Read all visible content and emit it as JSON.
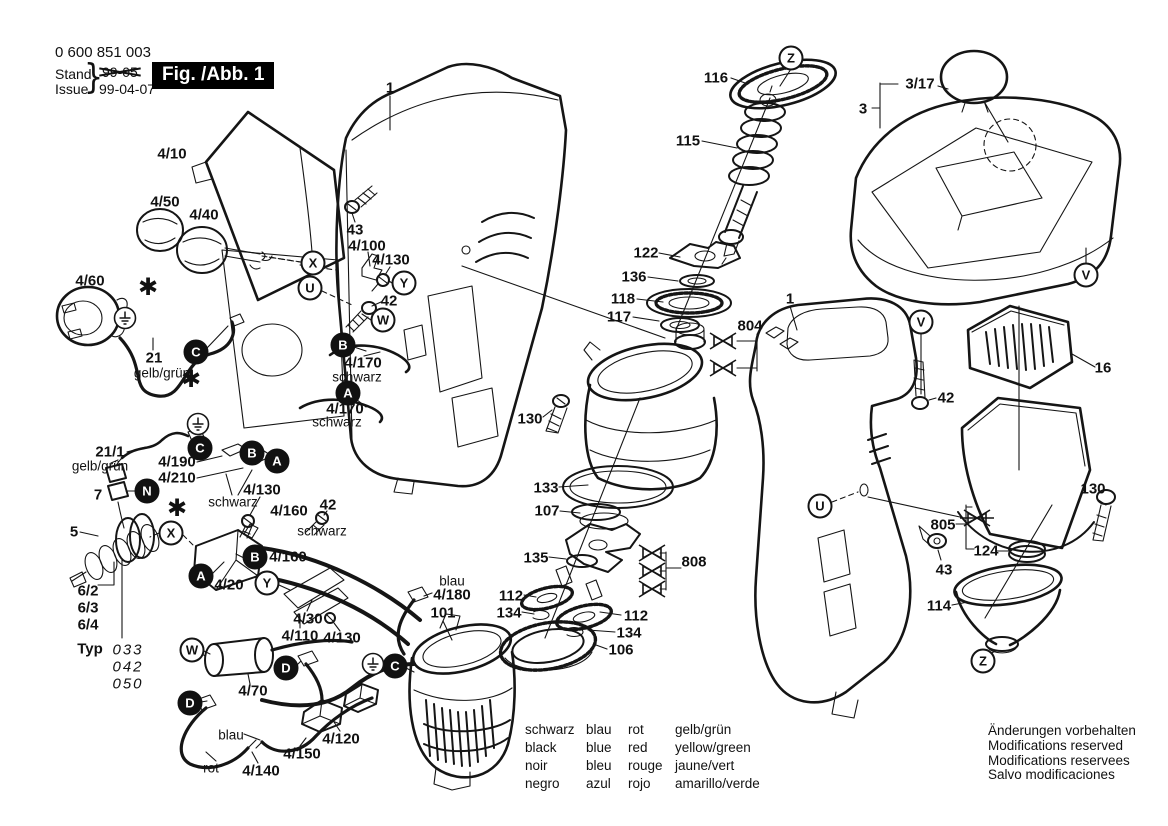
{
  "doc": {
    "part_number": "0 600 851 003",
    "stand_label": "Stand",
    "issue_label": "Issue",
    "brace": "}",
    "old_date": "99-05",
    "issue_date": "99-04-07",
    "figure_label": "Fig. /Abb. 1"
  },
  "legend": {
    "columns": [
      {
        "lines": [
          "schwarz",
          "black",
          "noir",
          "negro"
        ]
      },
      {
        "lines": [
          "blau",
          "blue",
          "bleu",
          "azul"
        ]
      },
      {
        "lines": [
          "rot",
          "red",
          "rouge",
          "rojo"
        ]
      },
      {
        "lines": [
          "gelb/grün",
          "yellow/green",
          "jaune/vert",
          "amarillo/verde"
        ]
      }
    ]
  },
  "footer": {
    "lines": [
      "Änderungen vorbehalten",
      "Modifications reserved",
      "Modifications reservees",
      "Salvo modificaciones"
    ]
  },
  "callout_labels": [
    {
      "text": "4/10",
      "x": 172,
      "y": 154
    },
    {
      "text": "4/50",
      "x": 165,
      "y": 202
    },
    {
      "text": "4/40",
      "x": 204,
      "y": 215
    },
    {
      "text": "4/60",
      "x": 90,
      "y": 281
    },
    {
      "text": "21",
      "x": 154,
      "y": 358
    },
    {
      "text": "gelb/grün",
      "x": 162,
      "y": 373,
      "style": "color-word"
    },
    {
      "text": "21/1",
      "x": 110,
      "y": 452
    },
    {
      "text": "gelb/grün",
      "x": 100,
      "y": 466,
      "style": "color-word"
    },
    {
      "text": "7",
      "x": 98,
      "y": 495
    },
    {
      "text": "5",
      "x": 74,
      "y": 532
    },
    {
      "text": "6/2",
      "x": 88,
      "y": 591
    },
    {
      "text": "6/3",
      "x": 88,
      "y": 608
    },
    {
      "text": "6/4",
      "x": 88,
      "y": 625
    },
    {
      "text": "Typ",
      "x": 90,
      "y": 649
    },
    {
      "text": "033",
      "x": 128,
      "y": 650,
      "style": "italic"
    },
    {
      "text": "042",
      "x": 128,
      "y": 667,
      "style": "italic"
    },
    {
      "text": "050",
      "x": 128,
      "y": 684,
      "style": "italic"
    },
    {
      "text": "4/190",
      "x": 177,
      "y": 462
    },
    {
      "text": "4/210",
      "x": 177,
      "y": 478
    },
    {
      "text": "schwarz",
      "x": 233,
      "y": 502,
      "style": "color-word"
    },
    {
      "text": "4/130",
      "x": 262,
      "y": 490
    },
    {
      "text": "42",
      "x": 328,
      "y": 505
    },
    {
      "text": "4/160",
      "x": 289,
      "y": 511
    },
    {
      "text": "schwarz",
      "x": 322,
      "y": 531,
      "style": "color-word"
    },
    {
      "text": "4/160",
      "x": 288,
      "y": 557
    },
    {
      "text": "4/20",
      "x": 229,
      "y": 585
    },
    {
      "text": "4/30",
      "x": 308,
      "y": 619
    },
    {
      "text": "4/110",
      "x": 300,
      "y": 636
    },
    {
      "text": "4/130",
      "x": 342,
      "y": 638
    },
    {
      "text": "4/70",
      "x": 253,
      "y": 691
    },
    {
      "text": "blau",
      "x": 231,
      "y": 735,
      "style": "color-word"
    },
    {
      "text": "rot",
      "x": 211,
      "y": 768,
      "style": "color-word"
    },
    {
      "text": "4/140",
      "x": 261,
      "y": 771
    },
    {
      "text": "4/150",
      "x": 302,
      "y": 754
    },
    {
      "text": "4/120",
      "x": 341,
      "y": 739
    },
    {
      "text": "blau",
      "x": 452,
      "y": 581,
      "style": "color-word"
    },
    {
      "text": "4/180",
      "x": 452,
      "y": 595
    },
    {
      "text": "101",
      "x": 443,
      "y": 613
    },
    {
      "text": "43",
      "x": 355,
      "y": 230
    },
    {
      "text": "4/100",
      "x": 367,
      "y": 246
    },
    {
      "text": "4/130",
      "x": 391,
      "y": 260
    },
    {
      "text": "42",
      "x": 389,
      "y": 301
    },
    {
      "text": "4/170",
      "x": 363,
      "y": 363
    },
    {
      "text": "schwarz",
      "x": 357,
      "y": 377,
      "style": "color-word"
    },
    {
      "text": "4/170",
      "x": 345,
      "y": 409
    },
    {
      "text": "schwarz",
      "x": 337,
      "y": 422,
      "style": "color-word"
    },
    {
      "text": "1",
      "x": 390,
      "y": 88
    },
    {
      "text": "116",
      "x": 716,
      "y": 78
    },
    {
      "text": "115",
      "x": 688,
      "y": 141
    },
    {
      "text": "122",
      "x": 646,
      "y": 253
    },
    {
      "text": "136",
      "x": 634,
      "y": 277
    },
    {
      "text": "118",
      "x": 623,
      "y": 299
    },
    {
      "text": "117",
      "x": 619,
      "y": 317
    },
    {
      "text": "804",
      "x": 750,
      "y": 326
    },
    {
      "text": "1",
      "x": 790,
      "y": 299
    },
    {
      "text": "130",
      "x": 530,
      "y": 419
    },
    {
      "text": "133",
      "x": 546,
      "y": 488
    },
    {
      "text": "107",
      "x": 547,
      "y": 511
    },
    {
      "text": "135",
      "x": 536,
      "y": 558
    },
    {
      "text": "808",
      "x": 694,
      "y": 562
    },
    {
      "text": "112",
      "x": 511,
      "y": 596
    },
    {
      "text": "134",
      "x": 509,
      "y": 613
    },
    {
      "text": "112",
      "x": 636,
      "y": 616
    },
    {
      "text": "134",
      "x": 629,
      "y": 633
    },
    {
      "text": "106",
      "x": 621,
      "y": 650
    },
    {
      "text": "3/17",
      "x": 920,
      "y": 84
    },
    {
      "text": "3",
      "x": 863,
      "y": 109
    },
    {
      "text": "16",
      "x": 1103,
      "y": 368
    },
    {
      "text": "42",
      "x": 946,
      "y": 398
    },
    {
      "text": "805",
      "x": 943,
      "y": 525
    },
    {
      "text": "124",
      "x": 986,
      "y": 551
    },
    {
      "text": "130",
      "x": 1093,
      "y": 489
    },
    {
      "text": "43",
      "x": 944,
      "y": 570
    },
    {
      "text": "114",
      "x": 939,
      "y": 606
    }
  ],
  "letter_callouts": [
    {
      "letter": "X",
      "x": 313,
      "y": 263,
      "variant": "outline"
    },
    {
      "letter": "U",
      "x": 310,
      "y": 288,
      "variant": "outline"
    },
    {
      "letter": "Y",
      "x": 404,
      "y": 283,
      "variant": "outline"
    },
    {
      "letter": "W",
      "x": 383,
      "y": 320,
      "variant": "outline"
    },
    {
      "letter": "X",
      "x": 171,
      "y": 533,
      "variant": "outline"
    },
    {
      "letter": "Y",
      "x": 267,
      "y": 583,
      "variant": "outline"
    },
    {
      "letter": "W",
      "x": 192,
      "y": 650,
      "variant": "outline"
    },
    {
      "letter": "U",
      "x": 820,
      "y": 506,
      "variant": "outline"
    },
    {
      "letter": "V",
      "x": 921,
      "y": 322,
      "variant": "outline"
    },
    {
      "letter": "V",
      "x": 1086,
      "y": 275,
      "variant": "outline"
    },
    {
      "letter": "Z",
      "x": 791,
      "y": 58,
      "variant": "outline"
    },
    {
      "letter": "Z",
      "x": 983,
      "y": 661,
      "variant": "outline"
    },
    {
      "letter": "C",
      "x": 196,
      "y": 352,
      "variant": "filled"
    },
    {
      "letter": "B",
      "x": 343,
      "y": 345,
      "variant": "filled"
    },
    {
      "letter": "A",
      "x": 348,
      "y": 393,
      "variant": "filled"
    },
    {
      "letter": "C",
      "x": 200,
      "y": 448,
      "variant": "filled"
    },
    {
      "letter": "B",
      "x": 252,
      "y": 453,
      "variant": "filled"
    },
    {
      "letter": "A",
      "x": 277,
      "y": 461,
      "variant": "filled"
    },
    {
      "letter": "N",
      "x": 147,
      "y": 491,
      "variant": "filled"
    },
    {
      "letter": "B",
      "x": 255,
      "y": 557,
      "variant": "filled"
    },
    {
      "letter": "A",
      "x": 201,
      "y": 576,
      "variant": "filled"
    },
    {
      "letter": "D",
      "x": 286,
      "y": 668,
      "variant": "filled"
    },
    {
      "letter": "D",
      "x": 190,
      "y": 703,
      "variant": "filled"
    },
    {
      "letter": "C",
      "x": 395,
      "y": 666,
      "variant": "filled"
    }
  ],
  "symbols": {
    "asterisks": [
      {
        "x": 148,
        "y": 287
      },
      {
        "x": 191,
        "y": 379
      },
      {
        "x": 177,
        "y": 508
      }
    ],
    "ground_symbols": [
      {
        "x": 125,
        "y": 318
      },
      {
        "x": 198,
        "y": 424
      },
      {
        "x": 373,
        "y": 664
      }
    ],
    "deleted_fasteners": [
      {
        "x": 723,
        "y": 341
      },
      {
        "x": 723,
        "y": 368
      },
      {
        "x": 652,
        "y": 553
      },
      {
        "x": 652,
        "y": 571
      },
      {
        "x": 652,
        "y": 589
      },
      {
        "x": 977,
        "y": 518,
        "struck": true
      }
    ]
  },
  "colors": {
    "ink": "#151515",
    "background": "#ffffff"
  }
}
